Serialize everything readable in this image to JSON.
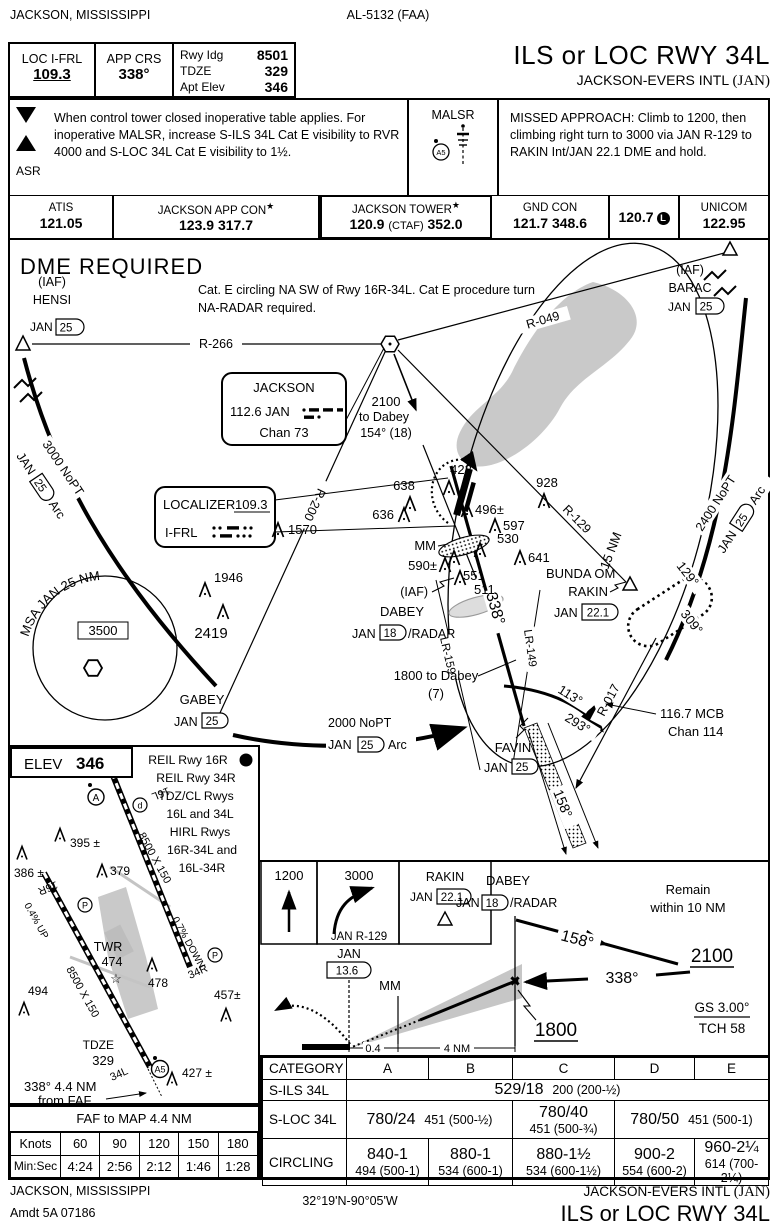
{
  "meta": {
    "colors": {
      "ink": "#000000",
      "gray_fill": "#c9c9c9",
      "muted": "#9a9a9a"
    }
  },
  "header": {
    "city": "JACKSON, MISSISSIPPI",
    "chart_id": "AL-5132 (FAA)",
    "procedure": "ILS or LOC RWY 34L",
    "airport": "JACKSON-EVERS INTL",
    "airport_code": "(JAN)"
  },
  "briefing": {
    "loc_label": "LOC I-FRL",
    "loc_freq": "109.3",
    "crs_label": "APP CRS",
    "crs_value": "338°",
    "rwy_rows": [
      {
        "label": "Rwy Idg",
        "value": "8501"
      },
      {
        "label": "TDZE",
        "value": "329"
      },
      {
        "label": "Apt Elev",
        "value": "346"
      }
    ],
    "takeoff_icon": "T",
    "alternate_icon": "A",
    "asr": "ASR",
    "notes": "When control tower closed inoperative table applies. For inoperative MALSR, increase S-ILS 34L Cat E visibility to RVR 4000 and S-LOC 34L Cat E visibility to 1½.",
    "malsr_label": "MALSR",
    "malsr_symbol": "A5",
    "missed_approach": "MISSED APPROACH: Climb to 1200, then climbing right turn to 3000 via JAN R-129 to RAKIN Int/JAN 22.1 DME and hold."
  },
  "frequencies": {
    "cells": [
      {
        "name": "ATIS",
        "value": "121.05"
      },
      {
        "name": "JACKSON APP CON",
        "star": "★",
        "value": "123.9 317.7"
      },
      {
        "name": "JACKSON TOWER",
        "star": "★",
        "v1": "120.9",
        "ctaf": "(CTAF)",
        "v2": "352.0"
      },
      {
        "name": "GND CON",
        "value": "121.7 348.6"
      },
      {
        "value": "120.7",
        "badge": "L"
      },
      {
        "name": "UNICOM",
        "value": "122.95"
      }
    ]
  },
  "plan": {
    "dme_note": "DME REQUIRED",
    "circling_note1": "Cat. E circling NA SW of  Rwy 16R-34L.  Cat E procedure turn",
    "circling_note2": "NA-RADAR required.",
    "ring": "15 NM",
    "msa_label": "MSA JAN 25 NM",
    "msa_alt": "3500",
    "vor_name": "JACKSON",
    "vor_freq": "112.6 JAN",
    "vor_chan": "Chan 73",
    "loc_label": "LOCALIZER",
    "loc_freq": "109.3",
    "loc_ident": "I-FRL",
    "radials": {
      "r266": "R-266",
      "r049": "R-049",
      "r200": "R-200",
      "r129": "R-129",
      "r017": "R-017"
    },
    "arcs": {
      "west_alt": "3000 NoPT",
      "south_alt": "2000 NoPT",
      "east_alt": "2400 NoPT",
      "nav": "JAN",
      "dme": "25",
      "arc": "Arc"
    },
    "fixes": {
      "iaf": "(IAF)",
      "hensi": "HENSI",
      "barac": "BARAC",
      "gabey": "GABEY",
      "dabey": "DABEY",
      "rakin": "RAKIN",
      "favin": "FAVIN",
      "bunda": "BUNDA OM",
      "jan": "JAN",
      "d25": "25",
      "d18": "18",
      "d221": "22.1",
      "radar_suffix": "/RADAR"
    },
    "feeder": {
      "alt": "2100",
      "to": "to Dabey",
      "crs": "154° (18)"
    },
    "stepdown": {
      "l1": "1800 to Dabey",
      "l2": "(7)"
    },
    "courses": {
      "final": "338°",
      "outbound": "158°",
      "hold_out": "129°",
      "hold_in": "309°",
      "t1": "113°",
      "t2": "293°",
      "lr159": "LR-159",
      "lr149": "LR-149"
    },
    "mcb1": "116.7 MCB",
    "mcb2": "Chan 114",
    "mm": "MM",
    "obstacles": [
      "1570",
      "1946",
      "2419",
      "638",
      "636",
      "422",
      "496±",
      "597",
      "530",
      "641",
      "928",
      "590±",
      "551",
      "511"
    ]
  },
  "sketch": {
    "elev_label": "ELEV",
    "elev_value": "346",
    "lighting": {
      "l1": "REIL Rwy 16R",
      "l1_badge": "L",
      "l2": "REIL Rwy 34R",
      "l3": "TDZ/CL Rwys",
      "l4": "16L and 34L",
      "l5": "HIRL Rwys",
      "l6": "16R-34L and",
      "l7": "16L-34R"
    },
    "rwy_size": "8500 X 150",
    "slope_up": "0.4% UP",
    "slope_down": "0.7% DOWN",
    "rwy_16r": "16R",
    "rwy_16l": "16L",
    "rwy_34l": "34L",
    "rwy_34r": "34R",
    "twr": "TWR",
    "twr_elev": "474",
    "tdze_label": "TDZE",
    "tdze_value": "329",
    "faf_crs": "338° 4.4 NM",
    "faf_from": "from FAF",
    "a5": "A5",
    "p_badge": "P",
    "d_badge": "d",
    "obstacles": [
      "395 ±",
      "386 ±",
      "379",
      "494",
      "478",
      "457±",
      "427 ±"
    ]
  },
  "timing": {
    "title": "FAF to MAP  4.4 NM",
    "row1": [
      "Knots",
      "60",
      "90",
      "120",
      "150",
      "180"
    ],
    "row2": [
      "Min:Sec",
      "4:24",
      "2:56",
      "2:12",
      "1:46",
      "1:28"
    ]
  },
  "profile": {
    "climb1": "1200",
    "climb2": "3000",
    "climb2_via": "JAN R-129",
    "hold_fix": "RAKIN",
    "hold_nav": "JAN",
    "hold_dme": "22.1",
    "dabey": "DABEY",
    "dabey_nav": "JAN",
    "dabey_dme": "18",
    "dabey_suffix": "/RADAR",
    "remain1": "Remain",
    "remain2": "within 10 NM",
    "out_crs": "158°",
    "pt_alt": "2100",
    "in_crs": "338°",
    "faf_alt": "1800",
    "gs": "GS 3.00°",
    "tch": "TCH 58",
    "jan": "JAN",
    "jan_dme": "13.6",
    "mm": "MM",
    "d1": "0.4",
    "d2": "4 NM"
  },
  "minimums": {
    "category_label": "CATEGORY",
    "cats": [
      "A",
      "B",
      "C",
      "D",
      "E"
    ],
    "s_ils": {
      "label": "S-ILS 34L",
      "value": "529/18",
      "hat": "200 (200-½)"
    },
    "s_loc": {
      "label": "S-LOC 34L",
      "ab": "780/24",
      "ab_hat": "451 (500-½)",
      "c": "780/40",
      "c_hat": "451 (500-¾)",
      "de": "780/50",
      "de_hat": "451 (500-1)"
    },
    "circling": {
      "label": "CIRCLING",
      "cells": [
        {
          "v": "840-1",
          "hat": "494 (500-1)"
        },
        {
          "v": "880-1",
          "hat": "534 (600-1)"
        },
        {
          "v": "880-1½",
          "hat": "534 (600-1½)"
        },
        {
          "v": "900-2",
          "hat": "554 (600-2)"
        },
        {
          "v": "960-2¼",
          "hat": "614 (700-2¼)"
        }
      ]
    }
  },
  "footer": {
    "city": "JACKSON, MISSISSIPPI",
    "amdt": "Amdt 5A  07186",
    "coords": "32°19'N-90°05'W",
    "airport": "JACKSON-EVERS INTL",
    "airport_code": "(JAN)",
    "procedure": "ILS or LOC RWY 34L"
  }
}
